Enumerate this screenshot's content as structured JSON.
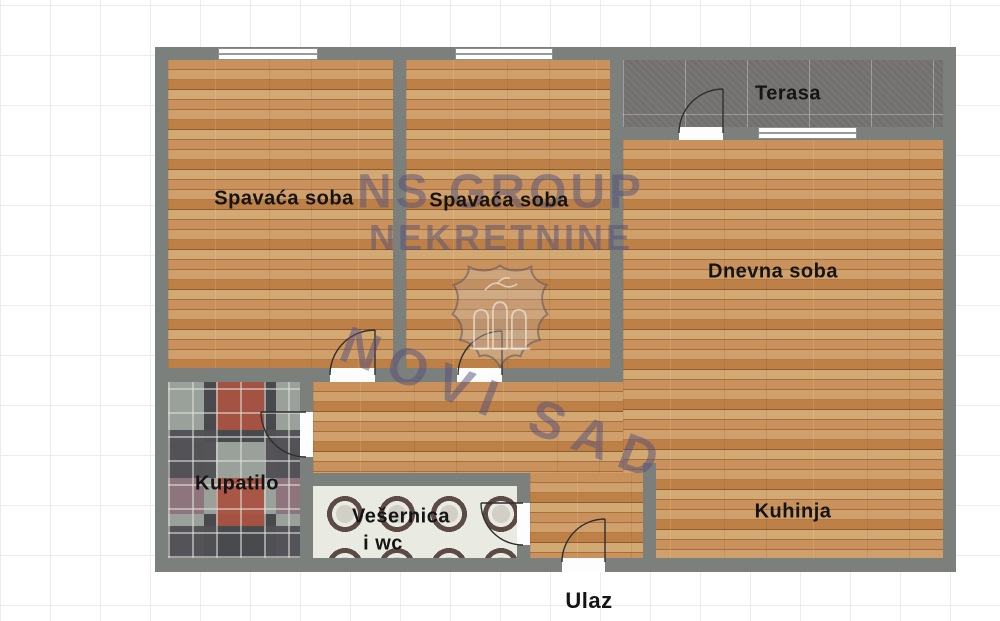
{
  "plan": {
    "rooms": {
      "bedroom1": "Spavaća soba",
      "bedroom2": "Spavaća soba",
      "terrace": "Terasa",
      "living": "Dnevna soba",
      "bathroom": "Kupatilo",
      "laundry_line1": "Vešernica",
      "laundry_line2": "i wc",
      "kitchen": "Kuhinja",
      "entrance": "Ulaz"
    },
    "watermark": {
      "line1": "NS GROUP",
      "line2": "NEKRETNINE",
      "line3": "NOVI SAD"
    },
    "colors": {
      "wall": "#7c807c",
      "wood_base": "#c08448",
      "terrace_tile": "#787675",
      "bath_tile_base": "#9aa09a",
      "laundry_tile_base": "#e9eae2",
      "watermark": "#55507a",
      "label": "#141414"
    }
  }
}
